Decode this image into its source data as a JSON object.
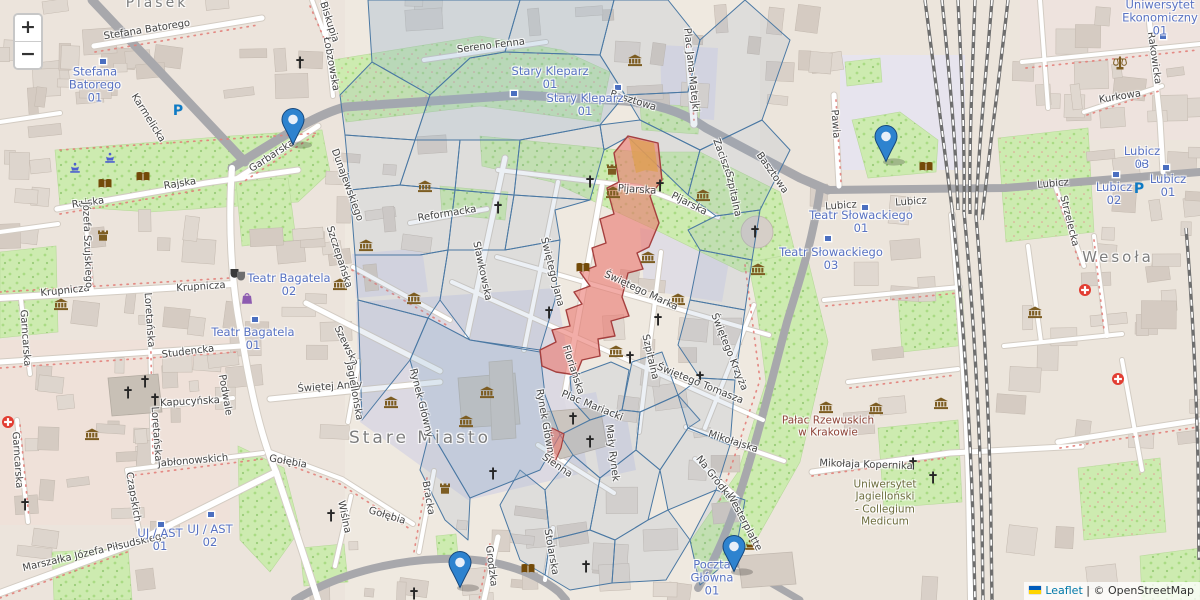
{
  "attribution": {
    "leaflet": "Leaflet",
    "separator": "|",
    "osm": "© OpenStreetMap"
  },
  "controls": {
    "zoom_in": "+",
    "zoom_out": "−"
  },
  "colors": {
    "marker_fill": "#2e83cf",
    "marker_border": "#17487c",
    "overlay_line": "#4a78a3",
    "overlay_fill": "rgba(136,164,191,0.16)",
    "overlay_fill_dense": "rgba(140,172,202,0.30)",
    "highlight_fill": "rgba(233,118,110,0.60)",
    "highlight_stroke": "#a5403f",
    "highlight_orange": "rgba(222,160,80,0.75)",
    "transit_text": "#5872c2",
    "leaflet_link": "#0078a8",
    "park": "#cdebb0",
    "pedestrian": "#dcd9e2"
  },
  "markers": [
    {
      "x": 293,
      "y": 146
    },
    {
      "x": 886,
      "y": 163
    },
    {
      "x": 460,
      "y": 589
    },
    {
      "x": 734,
      "y": 573
    }
  ],
  "labels": {
    "places": [
      {
        "t": "Stare Miasto",
        "x": 420,
        "y": 438,
        "s": 17
      },
      {
        "t": "Wesoła",
        "x": 1118,
        "y": 257,
        "s": 15
      },
      {
        "t": "Piasek",
        "x": 157,
        "y": 3,
        "s": 14
      }
    ],
    "pois": [
      {
        "lines": [
          "Pałac Rzewuskich",
          "w Krakowie"
        ],
        "x": 828,
        "y": 427,
        "c": "her"
      },
      {
        "lines": [
          "Uniwersytet",
          "Jagielloński",
          "- Collegium",
          "Medicum"
        ],
        "x": 885,
        "y": 503,
        "c": "uni"
      }
    ],
    "transit": [
      {
        "lines": [
          "Stefana",
          "Batorego",
          "01"
        ],
        "x": 95,
        "y": 85
      },
      {
        "lines": [
          "Stary Kleparz",
          "01"
        ],
        "x": 550,
        "y": 78
      },
      {
        "lines": [
          "Stary Kleparz",
          "01"
        ],
        "x": 585,
        "y": 105
      },
      {
        "lines": [
          "Teatr Bagatela",
          "02"
        ],
        "x": 289,
        "y": 285
      },
      {
        "lines": [
          "Teatr Bagatela",
          "01"
        ],
        "x": 253,
        "y": 339
      },
      {
        "lines": [
          "Teatr Słowackiego",
          "01"
        ],
        "x": 861,
        "y": 222
      },
      {
        "lines": [
          "Teatr Słowackiego",
          "03"
        ],
        "x": 831,
        "y": 259
      },
      {
        "lines": [
          "Lubicz",
          "03"
        ],
        "x": 1142,
        "y": 158
      },
      {
        "lines": [
          "Lubicz",
          "02"
        ],
        "x": 1114,
        "y": 194
      },
      {
        "lines": [
          "Lubicz",
          "01"
        ],
        "x": 1168,
        "y": 186
      },
      {
        "lines": [
          "Uniwersytet",
          "Ekonomiczny",
          "01"
        ],
        "x": 1160,
        "y": 18
      },
      {
        "lines": [
          "UJ / AST",
          "01"
        ],
        "x": 160,
        "y": 540
      },
      {
        "lines": [
          "UJ / AST",
          "02"
        ],
        "x": 210,
        "y": 536
      },
      {
        "lines": [
          "Poczta",
          "Główna",
          "01"
        ],
        "x": 712,
        "y": 578
      }
    ],
    "streets": [
      {
        "t": "Stefana Batorego",
        "x": 147,
        "y": 30,
        "r": -9
      },
      {
        "t": "Garbarska",
        "x": 272,
        "y": 156,
        "r": -33
      },
      {
        "t": "Rajska",
        "x": 180,
        "y": 184,
        "r": -9
      },
      {
        "t": "Rajska",
        "x": 88,
        "y": 203,
        "r": -8
      },
      {
        "t": "Karmelicka",
        "x": 148,
        "y": 118,
        "r": 58
      },
      {
        "t": "Biskupia",
        "x": 329,
        "y": 22,
        "r": 72
      },
      {
        "t": "Łobzowska",
        "x": 331,
        "y": 64,
        "r": 80
      },
      {
        "t": "Sereno Fenna",
        "x": 491,
        "y": 46,
        "r": -7
      },
      {
        "t": "Basztowa",
        "x": 633,
        "y": 101,
        "r": 17
      },
      {
        "t": "Basztowa",
        "x": 772,
        "y": 173,
        "r": 55
      },
      {
        "t": "Pijarska",
        "x": 637,
        "y": 190,
        "r": 4
      },
      {
        "t": "Pijarska",
        "x": 689,
        "y": 204,
        "r": 27
      },
      {
        "t": "Plac Jana Matejki",
        "x": 691,
        "y": 70,
        "r": 84
      },
      {
        "t": "Zacisze",
        "x": 722,
        "y": 157,
        "r": 70
      },
      {
        "t": "Pawia",
        "x": 835,
        "y": 124,
        "r": 86
      },
      {
        "t": "Lubicz",
        "x": 841,
        "y": 206,
        "r": -4
      },
      {
        "t": "Lubicz",
        "x": 911,
        "y": 202,
        "r": -4
      },
      {
        "t": "Lubicz",
        "x": 1053,
        "y": 184,
        "r": -5
      },
      {
        "t": "Kurkowa",
        "x": 1120,
        "y": 97,
        "r": -9
      },
      {
        "t": "Rakowicka",
        "x": 1154,
        "y": 58,
        "r": 82
      },
      {
        "t": "Strzelecka",
        "x": 1069,
        "y": 221,
        "r": 76
      },
      {
        "t": "Reformacka",
        "x": 447,
        "y": 214,
        "r": -9
      },
      {
        "t": "Sławkowska",
        "x": 482,
        "y": 271,
        "r": 78
      },
      {
        "t": "Świętego Jana",
        "x": 552,
        "y": 272,
        "r": 76
      },
      {
        "t": "Floriańska",
        "x": 573,
        "y": 370,
        "r": 72
      },
      {
        "t": "Szpitalna",
        "x": 650,
        "y": 357,
        "r": 77
      },
      {
        "t": "Szpitalna",
        "x": 733,
        "y": 194,
        "r": 78
      },
      {
        "t": "Świętego Marka",
        "x": 641,
        "y": 291,
        "r": 25
      },
      {
        "t": "Świętego Tomasza",
        "x": 700,
        "y": 384,
        "r": 22
      },
      {
        "t": "Świętego Krzyża",
        "x": 729,
        "y": 352,
        "r": 68
      },
      {
        "t": "Szczepańska",
        "x": 339,
        "y": 257,
        "r": 72
      },
      {
        "t": "Szewska",
        "x": 346,
        "y": 346,
        "r": 64
      },
      {
        "t": "Świętej Anny",
        "x": 330,
        "y": 387,
        "r": -4
      },
      {
        "t": "Jagiellońska",
        "x": 354,
        "y": 391,
        "r": 80
      },
      {
        "t": "Rynek Główny",
        "x": 421,
        "y": 403,
        "r": 76
      },
      {
        "t": "Rynek Główny",
        "x": 545,
        "y": 424,
        "r": 80
      },
      {
        "t": "Plac Mariacki",
        "x": 592,
        "y": 406,
        "r": 22
      },
      {
        "t": "Mały Rynek",
        "x": 612,
        "y": 453,
        "r": 83
      },
      {
        "t": "Mikołajska",
        "x": 733,
        "y": 442,
        "r": 18
      },
      {
        "t": "Na Gródku",
        "x": 714,
        "y": 478,
        "r": 52
      },
      {
        "t": "Sienna",
        "x": 557,
        "y": 466,
        "r": 34
      },
      {
        "t": "Grodzka",
        "x": 491,
        "y": 566,
        "r": 83
      },
      {
        "t": "Stolarska",
        "x": 551,
        "y": 552,
        "r": 80
      },
      {
        "t": "Bracka",
        "x": 428,
        "y": 498,
        "r": 80
      },
      {
        "t": "Gołębia",
        "x": 288,
        "y": 462,
        "r": 10
      },
      {
        "t": "Gołębia",
        "x": 387,
        "y": 516,
        "r": 17
      },
      {
        "t": "Wiślna",
        "x": 344,
        "y": 517,
        "r": 78
      },
      {
        "t": "Krupnicza",
        "x": 65,
        "y": 291,
        "r": -6
      },
      {
        "t": "Krupnicza",
        "x": 201,
        "y": 287,
        "r": -4
      },
      {
        "t": "Studencka",
        "x": 188,
        "y": 352,
        "r": -7
      },
      {
        "t": "Jabłonowskich",
        "x": 193,
        "y": 461,
        "r": -5
      },
      {
        "t": "Czapskich",
        "x": 133,
        "y": 497,
        "r": 80
      },
      {
        "t": "Loretańska",
        "x": 149,
        "y": 320,
        "r": 86
      },
      {
        "t": "Loretańska",
        "x": 156,
        "y": 434,
        "r": 86
      },
      {
        "t": "Kapucyńska",
        "x": 190,
        "y": 402,
        "r": -3
      },
      {
        "t": "Garncarska",
        "x": 25,
        "y": 338,
        "r": 86
      },
      {
        "t": "Garncarska",
        "x": 17,
        "y": 460,
        "r": 86
      },
      {
        "t": "Marszałka Józefa Piłsudskiego",
        "x": 95,
        "y": 552,
        "r": -13
      },
      {
        "t": "Józefa Szujskiego",
        "x": 87,
        "y": 245,
        "r": 88
      },
      {
        "t": "Podwale",
        "x": 225,
        "y": 395,
        "r": 80
      },
      {
        "t": "Westerplatte",
        "x": 744,
        "y": 522,
        "r": 62
      },
      {
        "t": "Mikołaja Kopernika",
        "x": 866,
        "y": 465,
        "r": 2
      },
      {
        "t": "Dunajewskiego",
        "x": 347,
        "y": 185,
        "r": 70
      }
    ]
  },
  "icons": {
    "museum": [
      [
        425,
        187
      ],
      [
        366,
        246
      ],
      [
        414,
        299
      ],
      [
        391,
        403
      ],
      [
        487,
        393
      ],
      [
        466,
        422
      ],
      [
        613,
        193
      ],
      [
        703,
        196
      ],
      [
        648,
        258
      ],
      [
        678,
        300
      ],
      [
        616,
        352
      ],
      [
        758,
        270
      ],
      [
        826,
        408
      ],
      [
        876,
        409
      ],
      [
        941,
        404
      ],
      [
        1035,
        313
      ],
      [
        61,
        305
      ],
      [
        92,
        435
      ],
      [
        340,
        285
      ],
      [
        635,
        61
      ]
    ],
    "church": [
      [
        300,
        63
      ],
      [
        128,
        393
      ],
      [
        145,
        382
      ],
      [
        25,
        505
      ],
      [
        155,
        400
      ],
      [
        498,
        208
      ],
      [
        590,
        182
      ],
      [
        660,
        186
      ],
      [
        755,
        232
      ],
      [
        549,
        313
      ],
      [
        658,
        320
      ],
      [
        630,
        358
      ],
      [
        700,
        378
      ],
      [
        573,
        419
      ],
      [
        590,
        442
      ],
      [
        493,
        474
      ],
      [
        586,
        567
      ],
      [
        414,
        594
      ],
      [
        331,
        516
      ],
      [
        933,
        478
      ],
      [
        913,
        464
      ]
    ],
    "book": [
      [
        583,
        267
      ],
      [
        105,
        183
      ],
      [
        143,
        176
      ],
      [
        528,
        568
      ],
      [
        926,
        166
      ]
    ],
    "castle": [
      [
        612,
        170
      ],
      [
        445,
        489
      ],
      [
        103,
        236
      ]
    ],
    "fountain": [
      [
        75,
        168
      ],
      [
        110,
        158
      ]
    ],
    "hospital": [
      [
        8,
        423
      ],
      [
        1085,
        291
      ],
      [
        1118,
        380
      ]
    ],
    "parking": [
      [
        178,
        112
      ],
      [
        1139,
        190
      ]
    ],
    "theater": [
      [
        238,
        275
      ]
    ],
    "mall": [
      [
        247,
        299
      ]
    ],
    "justice": [
      [
        1120,
        64
      ]
    ],
    "attraction": [
      [
        750,
        545
      ]
    ],
    "stop": [
      [
        103,
        60
      ],
      [
        514,
        92
      ],
      [
        618,
        86
      ],
      [
        255,
        318
      ],
      [
        865,
        206
      ],
      [
        828,
        237
      ],
      [
        161,
        523
      ],
      [
        211,
        513
      ],
      [
        1116,
        173
      ],
      [
        1166,
        166
      ],
      [
        1141,
        163
      ],
      [
        1163,
        35
      ]
    ]
  }
}
